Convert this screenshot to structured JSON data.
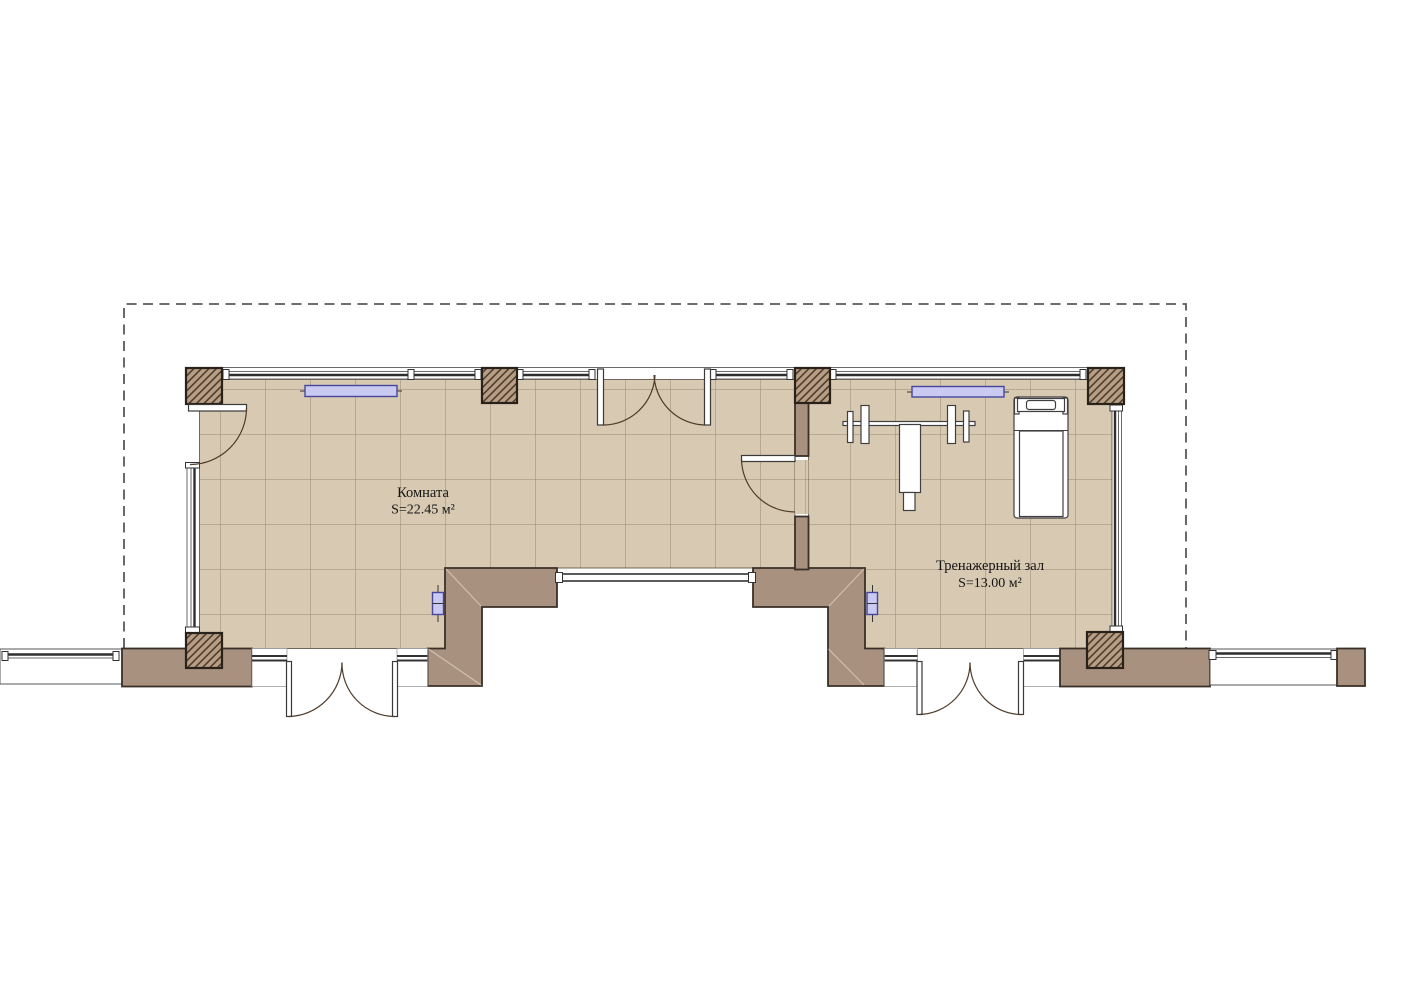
{
  "plan": {
    "rooms": [
      {
        "name": "Комната",
        "area_label": "S=22.45 м²"
      },
      {
        "name": "Тренажерный зал",
        "area_label": "S=13.00 м²"
      }
    ],
    "symbols": {
      "columns": "hatched-column",
      "fixtures": [
        "radiator",
        "radiator",
        "socket",
        "socket"
      ],
      "equipment": [
        "bench-press",
        "treadmill"
      ],
      "doors": [
        "left-wall-single",
        "top-double",
        "partition-single",
        "bottom-left-double",
        "bottom-right-double"
      ],
      "windows": [
        "top-strip-windows",
        "left-wall-window",
        "right-wall-window",
        "niche-window",
        "neighbor-left-window",
        "neighbor-right-window"
      ]
    },
    "colors": {
      "floor": "#d8cab2",
      "wall_fill": "#a9917f",
      "wall_outline": "#3a3027",
      "column_fill": "#b79e87",
      "hatch_line": "#513e2a",
      "fixture_fill": "#c9c9f2",
      "fixture_stroke": "#46469b",
      "boundary_dash": "#595959",
      "equipment_stroke": "#3f3f3f",
      "label_color": "#141414"
    }
  }
}
